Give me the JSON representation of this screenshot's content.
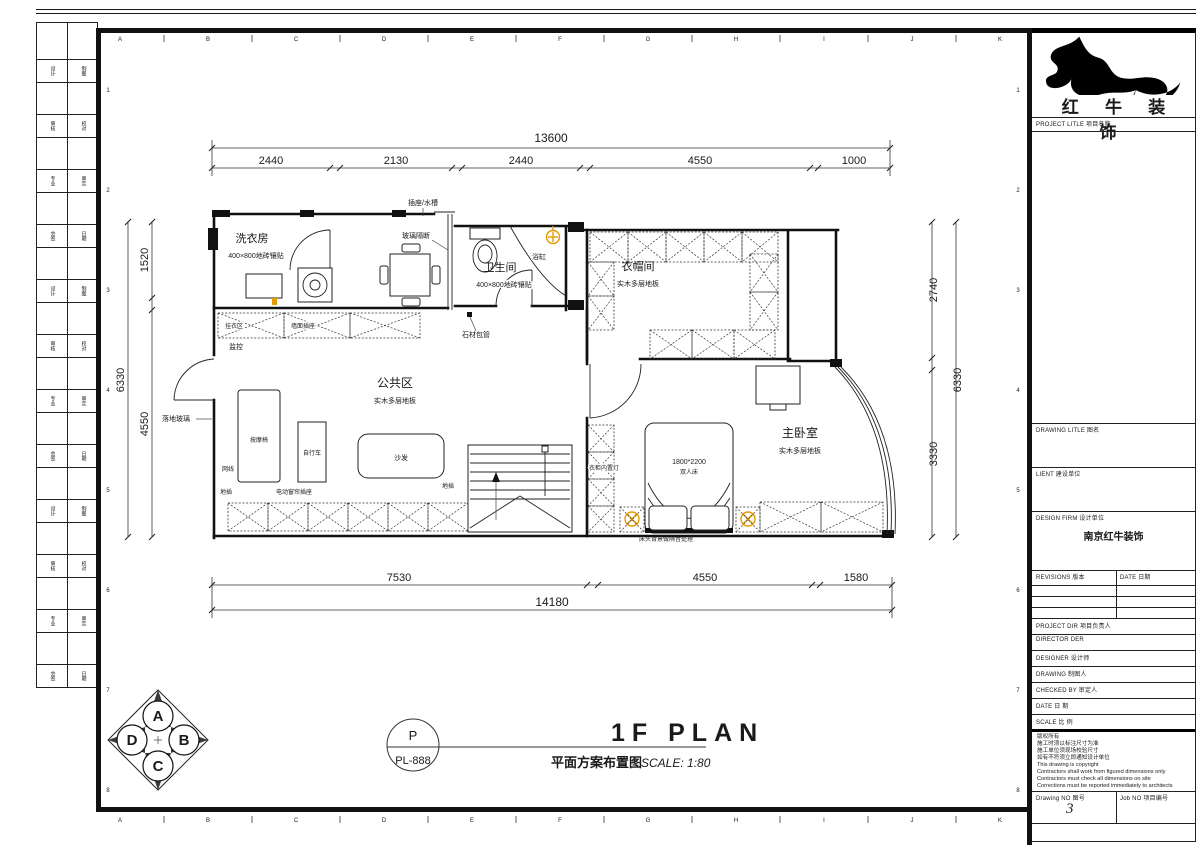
{
  "grid": {
    "cols": [
      "A",
      "B",
      "C",
      "D",
      "E",
      "F",
      "G",
      "H",
      "I",
      "J",
      "K"
    ],
    "rows": [
      "1",
      "2",
      "3",
      "4",
      "5",
      "6",
      "7",
      "8"
    ]
  },
  "dimensions": {
    "top": {
      "total": "13600",
      "segments": [
        "2440",
        "2130",
        "2440",
        "4550",
        "1000"
      ]
    },
    "bottom": {
      "total": "14180",
      "segments": [
        "7530",
        "4550",
        "1580"
      ]
    },
    "left": {
      "total": "6330",
      "segments": [
        "1520",
        "4550"
      ]
    },
    "right": {
      "total": "6330",
      "segments": [
        "2740",
        "3330"
      ]
    }
  },
  "rooms": {
    "laundry": {
      "name": "洗衣房",
      "floor": "400×800地砖镶贴"
    },
    "bathroom": {
      "name": "卫生间",
      "floor": "400×800地砖镶贴"
    },
    "cloakroom": {
      "name": "衣帽间",
      "floor": "实木多层地板"
    },
    "public": {
      "name": "公共区",
      "floor": "实木多层地板"
    },
    "master": {
      "name": "主卧室",
      "floor": "实木多层地板"
    }
  },
  "annotations": {
    "socket_sink": "插座/水槽",
    "glass_partition": "玻璃隔断",
    "bathtub": "浴缸",
    "stone_pipe": "石材包管",
    "hang_area": "挂衣区",
    "wall_socket": "墙面插座",
    "monitor": "监控",
    "floor_glass": "落地玻璃",
    "massage_chair": "按摩椅",
    "bicycle": "自行车",
    "sofa": "沙发",
    "network": "网线",
    "floor_socket": "地插",
    "curtain_socket": "电动窗帘插座",
    "wardrobe_light": "衣柜内置灯",
    "bed_size": "1800*2200",
    "bed_type": "双人床",
    "headboard_note": "床头背景做隔音处理"
  },
  "sheet_title": {
    "code_letter": "P",
    "code": "PL-888",
    "title_cn": "平面方案布置图",
    "title_en": "1F PLAN",
    "scale": "SCALE: 1:80"
  },
  "compass": {
    "n": "A",
    "e": "B",
    "s": "C",
    "w": "D"
  },
  "title_block": {
    "logo_text": "红 牛 装 饰",
    "project_title_label": "PROJECT LITLE  项目名称",
    "drawing_title_label": "DRAWING LITLE  图名",
    "client_label": "LIENT  建设单位",
    "design_firm_label": "DESIGN FIRM  设计单位",
    "design_firm_value": "南京红牛装饰",
    "revisions_label": "REVISIONS  版本",
    "date_col_label": "DATE  日期",
    "project_dir_label": "PROJECT DIR   项目负责人",
    "director_label": "DIRECTOR DER",
    "designer_label": "DESIGNER      设计师",
    "drawing_label": "DRAWING       制图人",
    "checked_label": "CHECKED BY    审定人",
    "date_label": "DATE          日 期",
    "scale_label": "SCALE         比 例",
    "notes": [
      "版权所有",
      "施工时须以标注尺寸为准",
      "施工单位须现场校验尺寸",
      "如有不符须立即通知设计单位",
      "This drawing is copyright",
      "Contractors shall work from figured dimensions only",
      "Contractors must check all dimensions on site",
      "Corrections must be reported immediately to architects"
    ],
    "drawing_no_label": "Drawing NO 图号",
    "drawing_no_value": "3",
    "job_no_label": "Job NO 项目编号"
  },
  "left_strip": {
    "rows": [
      [
        "设计",
        "制图"
      ],
      [
        "审核",
        "校对"
      ],
      [
        "专业",
        "审定"
      ],
      [
        "会签",
        "日期"
      ],
      [
        "设计",
        "制图"
      ],
      [
        "审核",
        "校对"
      ],
      [
        "专业",
        "审定"
      ],
      [
        "会签",
        "日期"
      ],
      [
        "设计",
        "制图"
      ],
      [
        "审核",
        "校对"
      ],
      [
        "专业",
        "审定"
      ],
      [
        "会签",
        "日期"
      ]
    ]
  },
  "colors": {
    "line": "#1a1a1a",
    "accent": "#e59a00",
    "hatch": "#333333"
  }
}
